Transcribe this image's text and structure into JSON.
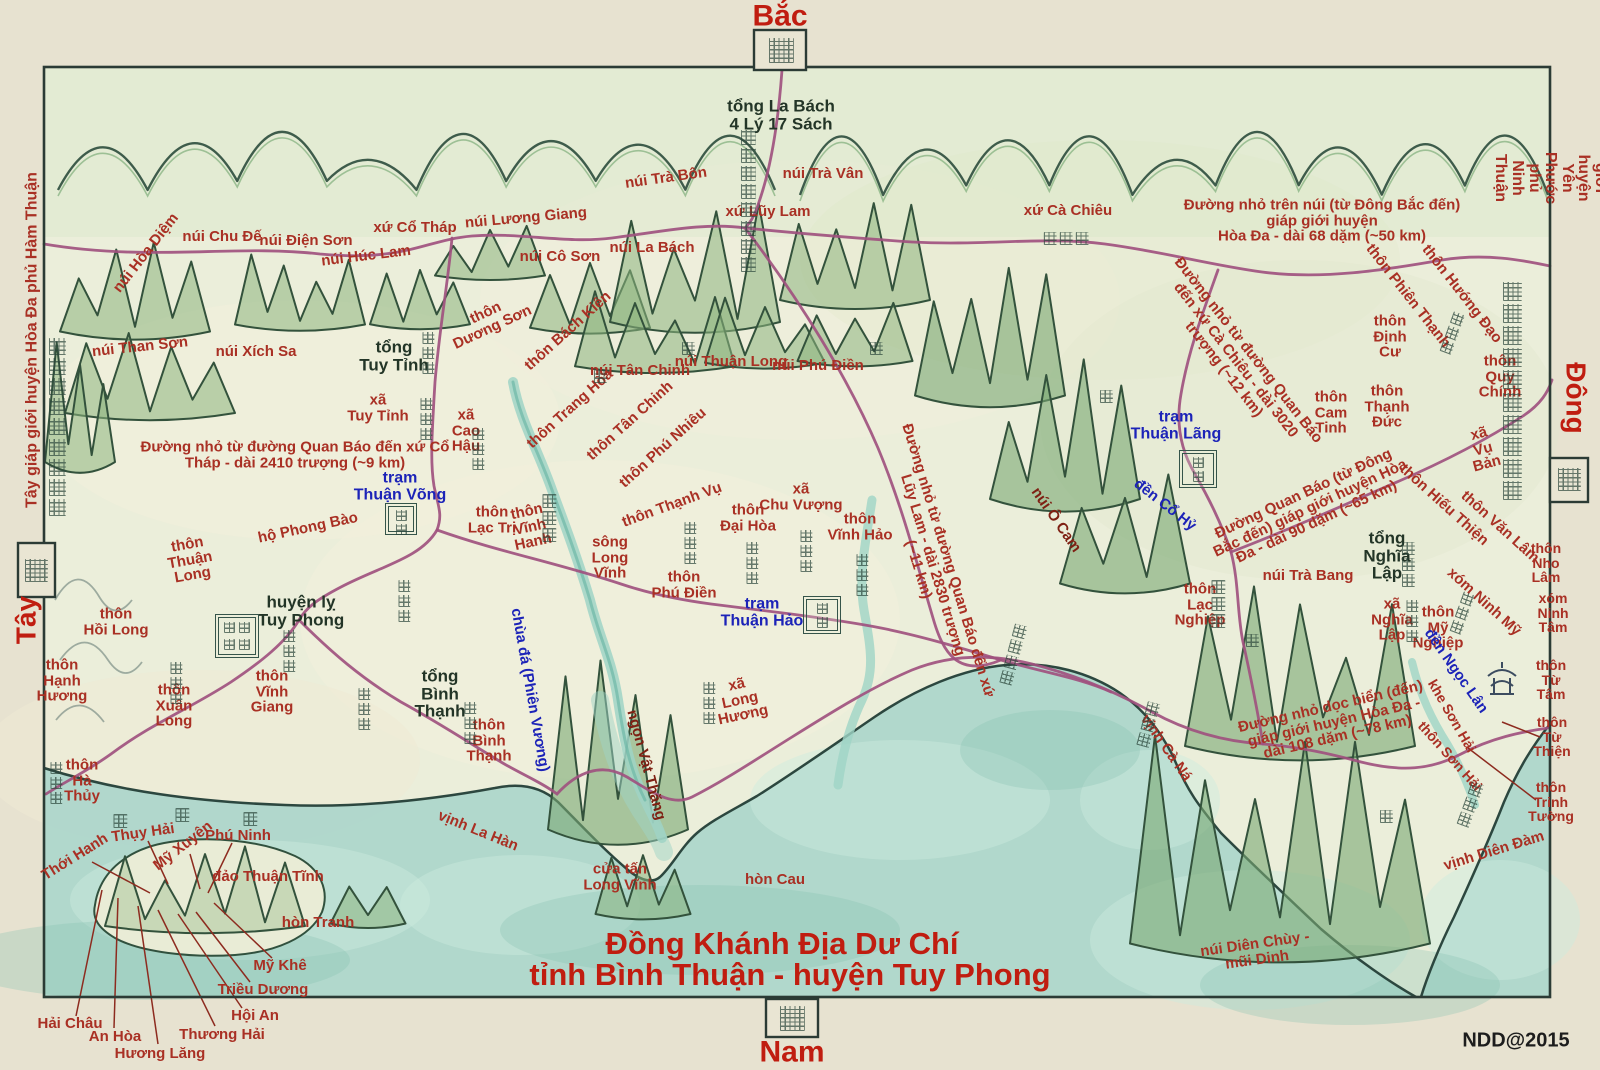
{
  "compass": {
    "north": "Bắc",
    "south": "Nam",
    "west": "Tây",
    "east": "Đông",
    "west_caption": "Tây giáp giới huyện Hòa Đa phủ Hàm Thuận",
    "east_caption": "Đông Bắc giáp giới huyện Yên Phước phủ Ninh Thuận",
    "north_gate_glyph": "北",
    "south_gate_glyph": "南",
    "west_box_glyph": "西",
    "east_box_glyph": "東"
  },
  "title": {
    "line1": "Đồng Khánh Địa Dư Chí",
    "line2": "tỉnh Bình Thuận - huyện Tuy Phong",
    "credit": "NDD@2015"
  },
  "colors": {
    "label_red": "#a93024",
    "label_blue": "#1c23b8",
    "label_ink": "#233527",
    "title_red": "#c01d10",
    "road_magenta": "#a0517f",
    "river_teal": "#9fd4c6",
    "sea_teal": "#aed6cb",
    "mountain_green": "#8db47e",
    "paper": "#ebeeda"
  },
  "map": {
    "labels": [
      {
        "t": "tổng La Bách\n4 Lý 17 Sách",
        "x": 781,
        "y": 115,
        "c": "ink",
        "s": 17
      },
      {
        "t": "núi Trà Bôn",
        "x": 666,
        "y": 178,
        "r": -8
      },
      {
        "t": "núi Trà Vân",
        "x": 823,
        "y": 174
      },
      {
        "t": "xứ Lũy Lam",
        "x": 768,
        "y": 212
      },
      {
        "t": "núi La Bách",
        "x": 652,
        "y": 248
      },
      {
        "t": "núi Lương Giang",
        "x": 526,
        "y": 218,
        "r": -5
      },
      {
        "t": "xứ Cổ Tháp",
        "x": 415,
        "y": 228
      },
      {
        "t": "núi Cô Sơn",
        "x": 560,
        "y": 257
      },
      {
        "t": "núi Chu Đế",
        "x": 222,
        "y": 237
      },
      {
        "t": "núi Điện Sơn",
        "x": 306,
        "y": 241
      },
      {
        "t": "núi Húc Lam",
        "x": 366,
        "y": 256,
        "r": -7
      },
      {
        "t": "núi Hòa Diệm",
        "x": 146,
        "y": 253,
        "r": -52
      },
      {
        "t": "núi Than Sơn",
        "x": 140,
        "y": 347,
        "r": -6
      },
      {
        "t": "núi Xích Sa",
        "x": 256,
        "y": 352
      },
      {
        "t": "xứ Cà Chiêu",
        "x": 1068,
        "y": 211
      },
      {
        "t": "Đường nhỏ trên núi (từ Đông Bắc đến) giáp giới huyện\nHòa Đa - dài 68 dặm (~50 km)",
        "x": 1322,
        "y": 221
      },
      {
        "t": "thôn\nDương Sơn",
        "x": 489,
        "y": 320,
        "r": -25
      },
      {
        "t": "thôn Bách Kiên",
        "x": 568,
        "y": 331,
        "r": -42
      },
      {
        "t": "núi Tân Chinh",
        "x": 640,
        "y": 371
      },
      {
        "t": "núi Thuận Long",
        "x": 731,
        "y": 362
      },
      {
        "t": "núi Phú Điền",
        "x": 818,
        "y": 366
      },
      {
        "t": "thôn Trang Hòa",
        "x": 570,
        "y": 409,
        "r": -42
      },
      {
        "t": "thôn Tân Chinh",
        "x": 630,
        "y": 421,
        "r": -42
      },
      {
        "t": "thôn Phú Nhiêu",
        "x": 663,
        "y": 448,
        "r": -42
      },
      {
        "t": "thôn Thạnh Vụ",
        "x": 672,
        "y": 505,
        "r": -20
      },
      {
        "t": "tổng\nTuy Tỉnh",
        "x": 394,
        "y": 356,
        "c": "ink",
        "s": 17
      },
      {
        "t": "xã\nTuy Tỉnh",
        "x": 378,
        "y": 408
      },
      {
        "t": "xã\nCao\nHậu",
        "x": 466,
        "y": 431
      },
      {
        "t": "Đường nhỏ từ đường Quan Báo đến xứ Cổ\nTháp - dài 2410 trượng (~9 km)",
        "x": 295,
        "y": 455
      },
      {
        "t": "trạm\nThuận Võng",
        "x": 400,
        "y": 487,
        "c": "blue",
        "s": 16
      },
      {
        "t": "hộ Phong Bào",
        "x": 308,
        "y": 528,
        "r": -12
      },
      {
        "t": "thôn\nThuận\nLong",
        "x": 190,
        "y": 560,
        "r": -10
      },
      {
        "t": "thôn\nHồi Long",
        "x": 116,
        "y": 622
      },
      {
        "t": "thôn\nHạnh\nHương",
        "x": 62,
        "y": 681
      },
      {
        "t": "thôn\nXuân\nLong",
        "x": 174,
        "y": 706
      },
      {
        "t": "thôn\nVĩnh\nGiang",
        "x": 272,
        "y": 692
      },
      {
        "t": "huyện lỵ\nTuy Phong",
        "x": 301,
        "y": 611,
        "c": "ink",
        "s": 17
      },
      {
        "t": "tổng\nBình\nThạnh",
        "x": 440,
        "y": 694,
        "c": "ink",
        "s": 17
      },
      {
        "t": "thôn\nBình\nThạnh",
        "x": 489,
        "y": 741
      },
      {
        "t": "chùa đá (Phiên Vương)",
        "x": 530,
        "y": 690,
        "c": "blue",
        "s": 15,
        "r": 80
      },
      {
        "t": "ngọn Vật Thăng",
        "x": 646,
        "y": 765,
        "c": "maroon",
        "r": 75
      },
      {
        "t": "vịnh La Hàn",
        "x": 478,
        "y": 831,
        "r": 22
      },
      {
        "t": "sông\nLong\nVĩnh",
        "x": 610,
        "y": 558
      },
      {
        "t": "thôn\nLạc Trị",
        "x": 492,
        "y": 520
      },
      {
        "t": "thôn\nVĩnh\nHanh",
        "x": 530,
        "y": 527,
        "r": -12
      },
      {
        "t": "thôn\nPhú Điền",
        "x": 684,
        "y": 585
      },
      {
        "t": "thôn\nĐại Hòa",
        "x": 748,
        "y": 518
      },
      {
        "t": "xã\nChu Vượng",
        "x": 801,
        "y": 497
      },
      {
        "t": "thôn\nVĩnh Hảo",
        "x": 860,
        "y": 527
      },
      {
        "t": "trạm\nThuận Hảo",
        "x": 762,
        "y": 613,
        "c": "blue",
        "s": 16
      },
      {
        "t": "xã\nLong\nHương",
        "x": 740,
        "y": 700,
        "r": -12
      },
      {
        "t": "cửa tấn\nLong Vĩnh",
        "x": 620,
        "y": 877
      },
      {
        "t": "hòn Cau",
        "x": 775,
        "y": 880
      },
      {
        "t": "thôn\nHà\nThủy",
        "x": 82,
        "y": 781
      },
      {
        "t": "Thới Hanh",
        "x": 75,
        "y": 857,
        "r": -32
      },
      {
        "t": "Thụy Hải",
        "x": 143,
        "y": 833,
        "r": -8
      },
      {
        "t": "Mỹ Xuyên",
        "x": 183,
        "y": 846,
        "r": -38
      },
      {
        "t": "Phú Ninh",
        "x": 238,
        "y": 836
      },
      {
        "t": "đảo Thuận Tĩnh",
        "x": 268,
        "y": 877
      },
      {
        "t": "hòn Tranh",
        "x": 318,
        "y": 923
      },
      {
        "t": "Mỹ Khê",
        "x": 280,
        "y": 966
      },
      {
        "t": "Triều Dương",
        "x": 263,
        "y": 990
      },
      {
        "t": "Hội An",
        "x": 255,
        "y": 1016
      },
      {
        "t": "Thương Hải",
        "x": 222,
        "y": 1035
      },
      {
        "t": "Hương Lăng",
        "x": 160,
        "y": 1054
      },
      {
        "t": "An Hòa",
        "x": 115,
        "y": 1037
      },
      {
        "t": "Hải Châu",
        "x": 70,
        "y": 1024
      },
      {
        "t": "Đường nhỏ từ đường Quan Báo đến xứ\nLũy Lam - dài 2830 trượng\n(~11 km)",
        "x": 933,
        "y": 565,
        "r": 73
      },
      {
        "t": "núi Ô Cam",
        "x": 1056,
        "y": 520,
        "c": "maroon",
        "r": 55
      },
      {
        "t": "trạm\nThuận Lãng",
        "x": 1176,
        "y": 426,
        "c": "blue",
        "s": 16
      },
      {
        "t": "đền Cổ Hỷ",
        "x": 1165,
        "y": 505,
        "c": "blue",
        "r": 38
      },
      {
        "t": "Đường nhỏ từ đường Quan Báo\nđến xứ Cà Chiêu - dài 3020\ntrượng (~12 km)",
        "x": 1236,
        "y": 360,
        "r": 52
      },
      {
        "t": "thôn Phiên Thạnh",
        "x": 1408,
        "y": 296,
        "r": 52
      },
      {
        "t": "thôn Hướng Đạo",
        "x": 1462,
        "y": 294,
        "r": 52
      },
      {
        "t": "thôn\nĐịnh\nCư",
        "x": 1390,
        "y": 337
      },
      {
        "t": "thôn\nQuy\nChính",
        "x": 1500,
        "y": 377
      },
      {
        "t": "xã\nVụ\nBản",
        "x": 1483,
        "y": 449,
        "r": -15
      },
      {
        "t": "thôn\nCam\nTinh",
        "x": 1331,
        "y": 413
      },
      {
        "t": "thôn\nThạnh\nĐức",
        "x": 1387,
        "y": 407
      },
      {
        "t": "Đường Quan Báo (từ Đông\nBắc đến) giáp giới huyện Hòa\nĐa - dài 90 dặm (~65 km)",
        "x": 1310,
        "y": 508,
        "r": -25
      },
      {
        "t": "tổng\nNghĩa\nLập",
        "x": 1387,
        "y": 556,
        "c": "ink",
        "s": 17
      },
      {
        "t": "núi Trà Bang",
        "x": 1308,
        "y": 576
      },
      {
        "t": "thôn Hiếu Thiện",
        "x": 1444,
        "y": 505,
        "r": 42
      },
      {
        "t": "thôn Văn Lâm",
        "x": 1500,
        "y": 527,
        "r": 42
      },
      {
        "t": "thôn\nNho Lâm",
        "x": 1546,
        "y": 563,
        "s": 14
      },
      {
        "t": "xóm Ninh Mỹ",
        "x": 1484,
        "y": 602,
        "r": 42
      },
      {
        "t": "xã\nNghĩa\nLập",
        "x": 1392,
        "y": 620
      },
      {
        "t": "thôn\nMỹ\nNghiệp",
        "x": 1438,
        "y": 628
      },
      {
        "t": "xóm\nNinh\nTâm",
        "x": 1553,
        "y": 613,
        "s": 14
      },
      {
        "t": "đền Ngọc Lân",
        "x": 1456,
        "y": 671,
        "c": "blue",
        "r": 55
      },
      {
        "t": "khe Sơn Hải",
        "x": 1452,
        "y": 716,
        "s": 14,
        "r": 60
      },
      {
        "t": "thôn Sơn Hải",
        "x": 1450,
        "y": 756,
        "s": 14,
        "r": 48
      },
      {
        "t": "thôn\nTừ\nTâm",
        "x": 1551,
        "y": 680,
        "s": 14
      },
      {
        "t": "thôn\nTừ\nThiện",
        "x": 1552,
        "y": 737,
        "s": 14
      },
      {
        "t": "thôn\nTrinh\nTường",
        "x": 1551,
        "y": 802,
        "s": 14
      },
      {
        "t": "vịnh Diên Đàm",
        "x": 1494,
        "y": 851,
        "r": -17
      },
      {
        "t": "vịnh Cà Ná",
        "x": 1166,
        "y": 748,
        "r": 55
      },
      {
        "t": "Đường nhỏ dọc biển (đến)\ngiáp giới huyện Hòa Đa -\ndài 108 dặm (~78 km)",
        "x": 1334,
        "y": 722,
        "r": -13
      },
      {
        "t": "núi Diên Chùy -\nmũi Dinh",
        "x": 1256,
        "y": 952,
        "r": -8
      },
      {
        "t": "thôn\nLạc\nNghiệp",
        "x": 1200,
        "y": 605
      }
    ],
    "seals": [
      {
        "x": 401,
        "y": 519,
        "w": 34,
        "glyphs": "站網",
        "note": "trạm Thuận Võng"
      },
      {
        "x": 822,
        "y": 615,
        "w": 40,
        "glyphs": "站好",
        "note": "trạm Thuận Hảo"
      },
      {
        "x": 1198,
        "y": 469,
        "w": 40,
        "glyphs": "站浪",
        "note": "trạm Thuận Lãng"
      },
      {
        "x": 237,
        "y": 636,
        "w": 46,
        "glyphs": "綏豐縣蒞",
        "note": "huyện lỵ Tuy Phong"
      }
    ]
  },
  "chinese_annotations": [
    {
      "text": "羅栢總四里十七柵",
      "x": 748,
      "y": 128,
      "s": 15
    },
    {
      "text": "西夾成順府禾多縣界",
      "x": 57,
      "y": 336,
      "s": 17
    },
    {
      "text": "東北夾寧順府安福縣界",
      "x": 1512,
      "y": 280,
      "s": 19
    },
    {
      "text": "龍永江",
      "x": 549,
      "y": 492,
      "s": 14
    },
    {
      "text": "龍永海汛",
      "x": 1013,
      "y": 622,
      "s": 13,
      "r": 15
    },
    {
      "text": "樂桒村",
      "x": 1218,
      "y": 578,
      "s": 14
    },
    {
      "text": "回龍村",
      "x": 289,
      "y": 628,
      "s": 12
    },
    {
      "text": "順隆村",
      "x": 404,
      "y": 578,
      "s": 12
    },
    {
      "text": "杏香村",
      "x": 176,
      "y": 660,
      "s": 12
    },
    {
      "text": "春隆村",
      "x": 364,
      "y": 686,
      "s": 12
    },
    {
      "text": "龍鄉社",
      "x": 709,
      "y": 680,
      "s": 12
    },
    {
      "text": "高厚社",
      "x": 478,
      "y": 426,
      "s": 12
    },
    {
      "text": "綏靖總",
      "x": 428,
      "y": 330,
      "s": 12
    },
    {
      "text": "綏靖社",
      "x": 426,
      "y": 396,
      "s": 12
    },
    {
      "text": "處相楞",
      "x": 1066,
      "y": 230,
      "s": 13,
      "horiz": true
    },
    {
      "text": "富田村",
      "x": 690,
      "y": 520,
      "s": 12
    },
    {
      "text": "大和村",
      "x": 752,
      "y": 540,
      "s": 12
    },
    {
      "text": "週旺社",
      "x": 806,
      "y": 528,
      "s": 12
    },
    {
      "text": "永好村",
      "x": 862,
      "y": 552,
      "s": 12
    },
    {
      "text": "平盛村",
      "x": 470,
      "y": 700,
      "s": 12
    },
    {
      "text": "義立總",
      "x": 1408,
      "y": 540,
      "s": 13
    },
    {
      "text": "義立社",
      "x": 1412,
      "y": 598,
      "s": 12
    },
    {
      "text": "美樂村",
      "x": 1462,
      "y": 590,
      "s": 12,
      "r": 20
    },
    {
      "text": "向道村",
      "x": 1452,
      "y": 310,
      "s": 12,
      "r": 20
    },
    {
      "text": "河水村",
      "x": 56,
      "y": 760,
      "s": 12
    },
    {
      "text": "延潭浪",
      "x": 1470,
      "y": 780,
      "s": 13,
      "r": 20
    },
    {
      "text": "坩梛浪",
      "x": 1148,
      "y": 700,
      "s": 13,
      "r": 15
    },
    {
      "text": "島",
      "x": 120,
      "y": 812,
      "s": 14
    },
    {
      "text": "靜",
      "x": 182,
      "y": 806,
      "s": 14
    },
    {
      "text": "順",
      "x": 250,
      "y": 810,
      "s": 14
    },
    {
      "text": "山",
      "x": 600,
      "y": 368,
      "s": 13
    },
    {
      "text": "山",
      "x": 688,
      "y": 340,
      "s": 13
    },
    {
      "text": "山",
      "x": 876,
      "y": 340,
      "s": 13
    },
    {
      "text": "山",
      "x": 1106,
      "y": 388,
      "s": 13
    },
    {
      "text": "山",
      "x": 1252,
      "y": 632,
      "s": 13
    },
    {
      "text": "山",
      "x": 1386,
      "y": 808,
      "s": 13
    }
  ]
}
